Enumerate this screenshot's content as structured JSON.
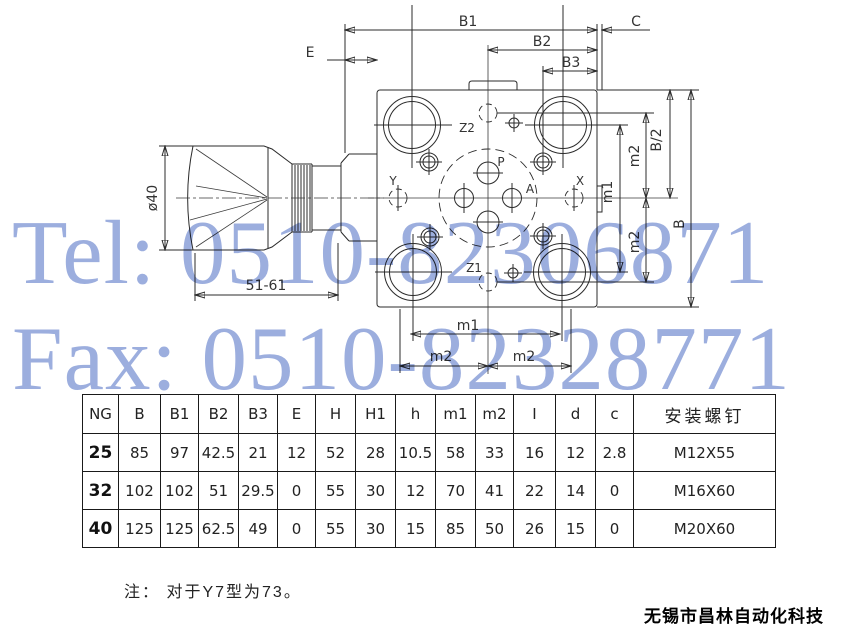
{
  "watermark": {
    "tel": "Tel: 0510-82306871",
    "fax": "Fax: 0510-82328771",
    "color": "#94a7dc"
  },
  "drawing": {
    "dims": {
      "b1": "B1",
      "b2": "B2",
      "b3": "B3",
      "c": "C",
      "e": "E",
      "phi": "ø40",
      "stroke_range": "51-61",
      "m1_vertical": "m1",
      "m2_vertical_top": "m2",
      "m2_vertical_bottom": "m2",
      "b_half": "B/2",
      "b": "B",
      "m1_horizontal": "m1",
      "m2_horizontal_left": "m2",
      "m2_horizontal_right": "m2"
    },
    "ports": {
      "z2": "Z2",
      "p": "P",
      "a": "A",
      "y": "Y",
      "x": "X",
      "z1": "Z1"
    }
  },
  "table": {
    "headers": [
      "NG",
      "B",
      "B1",
      "B2",
      "B3",
      "E",
      "H",
      "H1",
      "h",
      "m1",
      "m2",
      "I",
      "d",
      "c",
      "安装螺钉"
    ],
    "rows": [
      [
        "25",
        "85",
        "97",
        "42.5",
        "21",
        "12",
        "52",
        "28",
        "10.5",
        "58",
        "33",
        "16",
        "12",
        "2.8",
        "M12X55"
      ],
      [
        "32",
        "102",
        "102",
        "51",
        "29.5",
        "0",
        "55",
        "30",
        "12",
        "70",
        "41",
        "22",
        "14",
        "0",
        "M16X60"
      ],
      [
        "40",
        "125",
        "125",
        "62.5",
        "49",
        "0",
        "55",
        "30",
        "15",
        "85",
        "50",
        "26",
        "15",
        "0",
        "M20X60"
      ]
    ]
  },
  "note": "注： 对于Y7型为73。",
  "footer": "无锡市昌林自动化科技"
}
